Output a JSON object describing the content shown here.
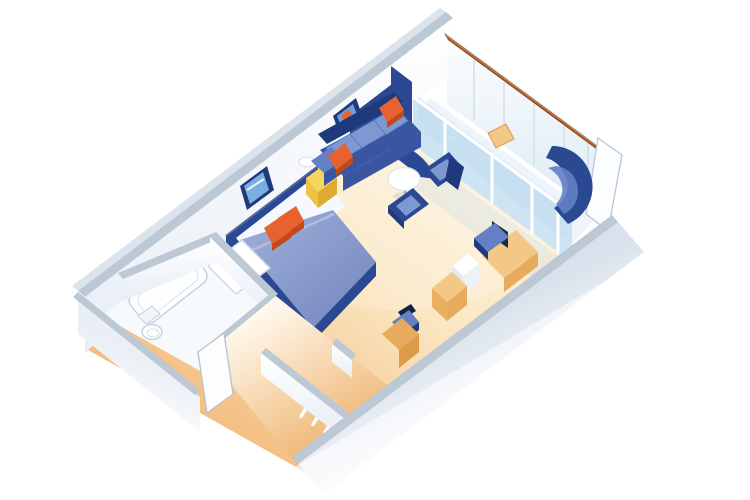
{
  "scene": {
    "type": "isometric-3d-cutaway-floorplan",
    "subject": "cruise-ship-suite-stateroom-render",
    "rooms": [
      {
        "name": "bedroom",
        "furniture": [
          "double-bed-blue-duvet",
          "navy-headboard",
          "orange-accent-pillows",
          "yellow-nightstand",
          "framed-seascape-art"
        ]
      },
      {
        "name": "living-area",
        "furniture": [
          "three-seat-blue-sofa",
          "orange-throw-pillows",
          "round-white-table",
          "blue-armchair-upper",
          "blue-armchair-lower",
          "curved-navy-lounge",
          "framed-art",
          "wall-sconce"
        ]
      },
      {
        "name": "work-vanity-area",
        "furniture": [
          "desk",
          "desk-chair",
          "mini-fridge-cabinet",
          "wood-cabinet",
          "vanity-stool",
          "vanity-cabinet"
        ]
      },
      {
        "name": "bathroom",
        "furniture": [
          "bathtub",
          "vanity-sink-counter",
          "toilet"
        ]
      },
      {
        "name": "entry",
        "furniture": [
          "cabin-door",
          "wardrobe-shelves"
        ]
      },
      {
        "name": "balcony",
        "furniture": [
          "railing-wall-wood-cap",
          "sliding-glass-doors",
          "deck-chair",
          "small-round-table"
        ]
      }
    ]
  },
  "palette": {
    "paper": "#ffffff",
    "wall-cap": "#bdc8d5",
    "wall-edge": "#97a5b6",
    "wall-face": "#f4f7fb",
    "wall-shade": "#dde6ef",
    "navy": "#2b4893",
    "navy-dark": "#1f3a7c",
    "blue": "#3a55a2",
    "blue-mid": "#6480c4",
    "blue-light": "#7e99d1",
    "duvet": "#8496c8",
    "duvet-light": "#a2b1da",
    "glass": "#bfdcf0",
    "glass-light": "#e1eef8",
    "orange": "#e8622f",
    "orange-dark": "#c2491c",
    "yellow": "#f4d55e",
    "yellow-dark": "#e0a92f",
    "wood": "#e8ab5e",
    "wood-light": "#f3c887",
    "wood-dark": "#dd9a47",
    "rail": "#8a4a22",
    "rail-light": "#c1793f",
    "floor-bright": "#fdf5e6",
    "floor-mid": "#fbe9c6",
    "floor-deep": "#f3bd80",
    "fixture": "#fdfefe",
    "fixture-line": "#c6d2de"
  }
}
